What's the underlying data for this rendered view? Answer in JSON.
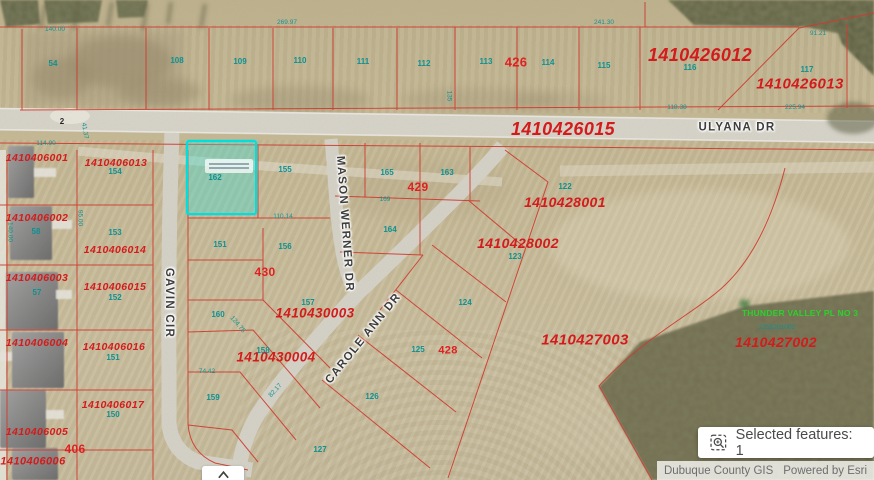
{
  "ui": {
    "selected_badge": {
      "label": "Selected features: 1",
      "icon": "selection-zoom-icon"
    },
    "attribution": {
      "source": "Dubuque County GIS",
      "powered": "Powered by Esri"
    },
    "expand_button": {
      "icon": "chevron-up-icon"
    }
  },
  "map": {
    "colors": {
      "parcel_line": "#d2372b",
      "parcel_id_text": "#d41b1b",
      "lot_text": "#0d9191",
      "block_text": "#e02020",
      "street_text": "#3d3d3d",
      "selection": "#00dede",
      "subdivision_text": "#2bd22b"
    },
    "streets": [
      {
        "name": "ULYANA DR",
        "x": 737,
        "y": 128,
        "rotate": 0
      },
      {
        "name": "GAVIN CIR",
        "x": 168,
        "y": 303,
        "rotate": 90
      },
      {
        "name": "MASON WERNER DR",
        "x": 344,
        "y": 224,
        "rotate": 86
      },
      {
        "name": "CAROLE ANN DR",
        "x": 364,
        "y": 339,
        "rotate": -51
      }
    ],
    "parcel_ids": [
      {
        "t": "1410406001",
        "x": 37,
        "y": 158,
        "s": 10.5
      },
      {
        "t": "1410406013",
        "x": 116,
        "y": 163,
        "s": 10.5
      },
      {
        "t": "1410406002",
        "x": 37,
        "y": 218,
        "s": 10.5
      },
      {
        "t": "1410406014",
        "x": 115,
        "y": 250,
        "s": 10.5
      },
      {
        "t": "1410406003",
        "x": 37,
        "y": 278,
        "s": 10.5
      },
      {
        "t": "1410406015",
        "x": 115,
        "y": 287,
        "s": 10.5
      },
      {
        "t": "1410406004",
        "x": 37,
        "y": 343,
        "s": 10.5
      },
      {
        "t": "1410406016",
        "x": 114,
        "y": 347,
        "s": 10.5
      },
      {
        "t": "1410406017",
        "x": 113,
        "y": 405,
        "s": 10.5
      },
      {
        "t": "1410406005",
        "x": 37,
        "y": 432,
        "s": 10.5
      },
      {
        "t": "1410406006",
        "x": 33,
        "y": 462,
        "s": 11
      },
      {
        "t": "1410426012",
        "x": 700,
        "y": 55,
        "s": 18
      },
      {
        "t": "1410426013",
        "x": 800,
        "y": 84,
        "s": 15
      },
      {
        "t": "1410426015",
        "x": 563,
        "y": 129,
        "s": 18
      },
      {
        "t": "1410428001",
        "x": 565,
        "y": 202,
        "s": 14
      },
      {
        "t": "1410428002",
        "x": 518,
        "y": 243,
        "s": 14
      },
      {
        "t": "1410430003",
        "x": 315,
        "y": 313,
        "s": 13.5
      },
      {
        "t": "1410430004",
        "x": 276,
        "y": 357,
        "s": 13.5
      },
      {
        "t": "1410427003",
        "x": 585,
        "y": 340,
        "s": 15
      },
      {
        "t": "1410427002",
        "x": 776,
        "y": 342,
        "s": 14
      }
    ],
    "block_numbers": [
      {
        "t": "426",
        "x": 516,
        "y": 62,
        "s": 13
      },
      {
        "t": "429",
        "x": 418,
        "y": 187,
        "s": 12
      },
      {
        "t": "430",
        "x": 265,
        "y": 272,
        "s": 12
      },
      {
        "t": "428",
        "x": 448,
        "y": 351,
        "s": 11
      },
      {
        "t": "406",
        "x": 75,
        "y": 449,
        "s": 12
      }
    ],
    "lot_numbers": [
      {
        "t": "54",
        "x": 53,
        "y": 64
      },
      {
        "t": "108",
        "x": 177,
        "y": 61
      },
      {
        "t": "109",
        "x": 240,
        "y": 62
      },
      {
        "t": "110",
        "x": 300,
        "y": 61
      },
      {
        "t": "111",
        "x": 363,
        "y": 62
      },
      {
        "t": "112",
        "x": 424,
        "y": 64
      },
      {
        "t": "113",
        "x": 486,
        "y": 62
      },
      {
        "t": "114",
        "x": 548,
        "y": 63
      },
      {
        "t": "115",
        "x": 604,
        "y": 66
      },
      {
        "t": "116",
        "x": 690,
        "y": 68
      },
      {
        "t": "117",
        "x": 807,
        "y": 70
      },
      {
        "t": "154",
        "x": 115,
        "y": 172
      },
      {
        "t": "153",
        "x": 115,
        "y": 233
      },
      {
        "t": "152",
        "x": 115,
        "y": 298
      },
      {
        "t": "151",
        "x": 113,
        "y": 358
      },
      {
        "t": "150",
        "x": 113,
        "y": 415
      },
      {
        "t": "58",
        "x": 36,
        "y": 232
      },
      {
        "t": "57",
        "x": 37,
        "y": 293
      },
      {
        "t": "162",
        "x": 215,
        "y": 178
      },
      {
        "t": "155",
        "x": 285,
        "y": 170
      },
      {
        "t": "165",
        "x": 387,
        "y": 173
      },
      {
        "t": "163",
        "x": 447,
        "y": 173
      },
      {
        "t": "164",
        "x": 390,
        "y": 230
      },
      {
        "t": "151",
        "x": 220,
        "y": 245
      },
      {
        "t": "156",
        "x": 285,
        "y": 247
      },
      {
        "t": "157",
        "x": 308,
        "y": 303
      },
      {
        "t": "160",
        "x": 218,
        "y": 315
      },
      {
        "t": "158",
        "x": 263,
        "y": 351
      },
      {
        "t": "159",
        "x": 213,
        "y": 398
      },
      {
        "t": "122",
        "x": 565,
        "y": 187
      },
      {
        "t": "123",
        "x": 515,
        "y": 257
      },
      {
        "t": "124",
        "x": 465,
        "y": 303
      },
      {
        "t": "125",
        "x": 418,
        "y": 350
      },
      {
        "t": "126",
        "x": 372,
        "y": 397
      },
      {
        "t": "127",
        "x": 320,
        "y": 450
      }
    ],
    "dimensions": [
      {
        "t": "140.00",
        "x": 55,
        "y": 30
      },
      {
        "t": "269.97",
        "x": 287,
        "y": 23
      },
      {
        "t": "241.30",
        "x": 604,
        "y": 23
      },
      {
        "t": "91.21",
        "x": 818,
        "y": 34
      },
      {
        "t": "225.94",
        "x": 795,
        "y": 108
      },
      {
        "t": "118.38",
        "x": 677,
        "y": 108
      },
      {
        "t": "110.14",
        "x": 283,
        "y": 217
      },
      {
        "t": "74.42",
        "x": 207,
        "y": 372
      },
      {
        "t": "82.17",
        "x": 276,
        "y": 391,
        "r": -48
      },
      {
        "t": "41.37",
        "x": 84,
        "y": 131,
        "r": 80
      },
      {
        "t": "114.90",
        "x": 46,
        "y": 144
      },
      {
        "t": "169",
        "x": 385,
        "y": 200
      },
      {
        "t": "140.00",
        "x": 9,
        "y": 232,
        "r": 90
      },
      {
        "t": "95.00",
        "x": 79,
        "y": 218,
        "r": 90
      },
      {
        "t": "135",
        "x": 448,
        "y": 96,
        "r": 90
      },
      {
        "t": "124.75",
        "x": 237,
        "y": 325,
        "r": 50
      },
      {
        "t": "2",
        "x": 62,
        "y": 122,
        "c": "dark",
        "s": 8
      }
    ],
    "subdivision": {
      "name": "THUNDER VALLEY PL NO 3",
      "x": 800,
      "y": 313,
      "id": "2255201002",
      "id_x": 777,
      "id_y": 328
    },
    "selected_parcel": {
      "lot": "162",
      "x": 186,
      "y": 140,
      "width": 71,
      "height": 75
    }
  }
}
